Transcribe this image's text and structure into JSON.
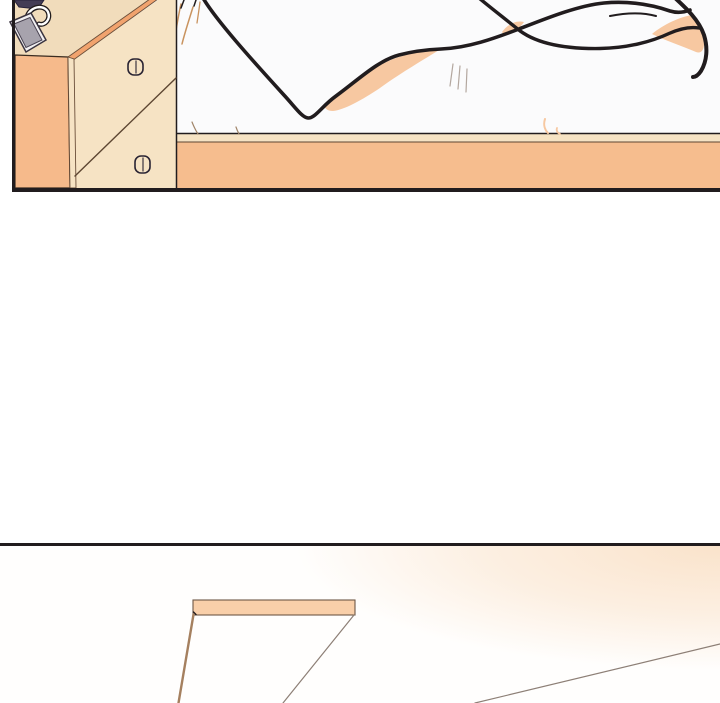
{
  "page": {
    "type": "webtoon-comic-strip",
    "panel_count": 2,
    "label_top_panel": "bedroom scene: nightstand with phone beside an empty bed with draped white blanket",
    "label_bottom_panel": "ceiling view: hanging fluorescent light bar with warm light glow from upper right"
  },
  "panel_top": {
    "objects": [
      "nightstand-side-face",
      "nightstand-top-surface",
      "drawer-front",
      "drawer-divider",
      "drawer-knob-upper",
      "drawer-knob-lower",
      "phone-on-nightstand",
      "charging-cable",
      "dark-object-corner",
      "hair-wisps",
      "blanket-outline-main",
      "blanket-outline-upper",
      "blanket-fold-right",
      "sheet-shadow-left",
      "sheet-shadow-middle",
      "sheet-shadow-right",
      "bed-frame-rail"
    ]
  },
  "panel_bottom": {
    "objects": [
      "pendant-light-bar",
      "lamp-edge-left",
      "lamp-edge-right",
      "floor-edge-line",
      "light-glow"
    ]
  },
  "colors": {
    "page_bg": "#ffffff",
    "panel_bg": "#fbfbfc",
    "panel2_bg": "#fffefd",
    "outline": "#211c1e",
    "cream": "#f6e3c4",
    "cream_dark": "#f1dcbb",
    "orange": "#f6ba8b",
    "edge_orange": "#f1a36e",
    "bed_frame_orange": "#f6bd8e",
    "knob": "#5a4f66",
    "knob_outline": "#2a2433",
    "peach": "#f7c8a1",
    "wedge_navy": "#433c55",
    "phone_body": "#f2f0f2",
    "phone_screen": "#a7a3ad",
    "hair_tan": "#c9935f",
    "tick_grey": "#b3a79f",
    "mark_brown": "#a08468",
    "line_thin": "#5d4632",
    "lamp_bar": "#f9cfa9",
    "cord_tan": "#a5805f",
    "line_grey": "#8d7f76",
    "glow": "#fae3cb"
  }
}
